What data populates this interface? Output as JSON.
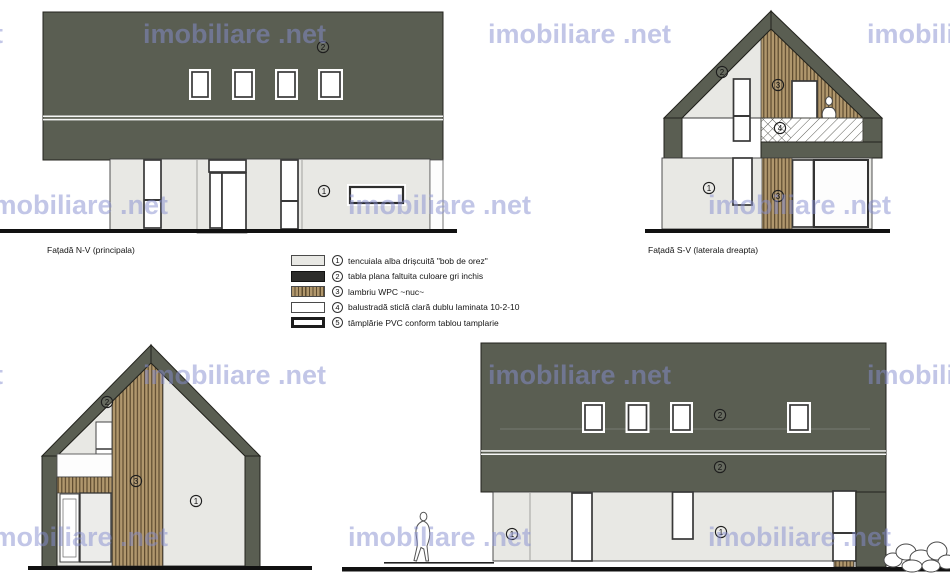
{
  "watermark": {
    "text": "imobiliare .net",
    "color": "#868dd0"
  },
  "legend": {
    "items": [
      {
        "num": "1",
        "label": "tencuiala alba drișcuită \"bob de orez\"",
        "swatch": "plaster"
      },
      {
        "num": "2",
        "label": "tabla plana faltuita culoare gri inchis",
        "swatch": "metal"
      },
      {
        "num": "3",
        "label": "lambriu WPC ~nuc~",
        "swatch": "wood"
      },
      {
        "num": "4",
        "label": "balustradă sticlă clară dublu laminata 10-2-10",
        "swatch": "glass"
      },
      {
        "num": "5",
        "label": "tâmplărie PVC conform tablou tamplarie",
        "swatch": "pvc"
      }
    ]
  },
  "facades": {
    "nv": {
      "label": "Fațadă N-V (principala)",
      "markers": {
        "plaster": "1",
        "metal": "2"
      }
    },
    "sv": {
      "label": "Fațadă S-V (laterala dreapta)",
      "markers": {
        "plaster": "1",
        "metal": "2",
        "wood_top": "3",
        "wood_bottom": "3",
        "glass": "4"
      }
    },
    "ne": {
      "markers": {
        "plaster": "1",
        "metal": "2",
        "wood": "3"
      }
    },
    "se": {
      "markers": {
        "plaster_left": "1",
        "plaster_right": "1",
        "metal_top": "2",
        "metal_bottom": "2"
      }
    }
  },
  "colors": {
    "metal_dark": "#5a5e52",
    "plaster_light": "#e8e8e4",
    "wood_light": "#b0976d",
    "wood_dark": "#5d4b2f",
    "ground": "#111111",
    "watermark": "#868dd0"
  }
}
